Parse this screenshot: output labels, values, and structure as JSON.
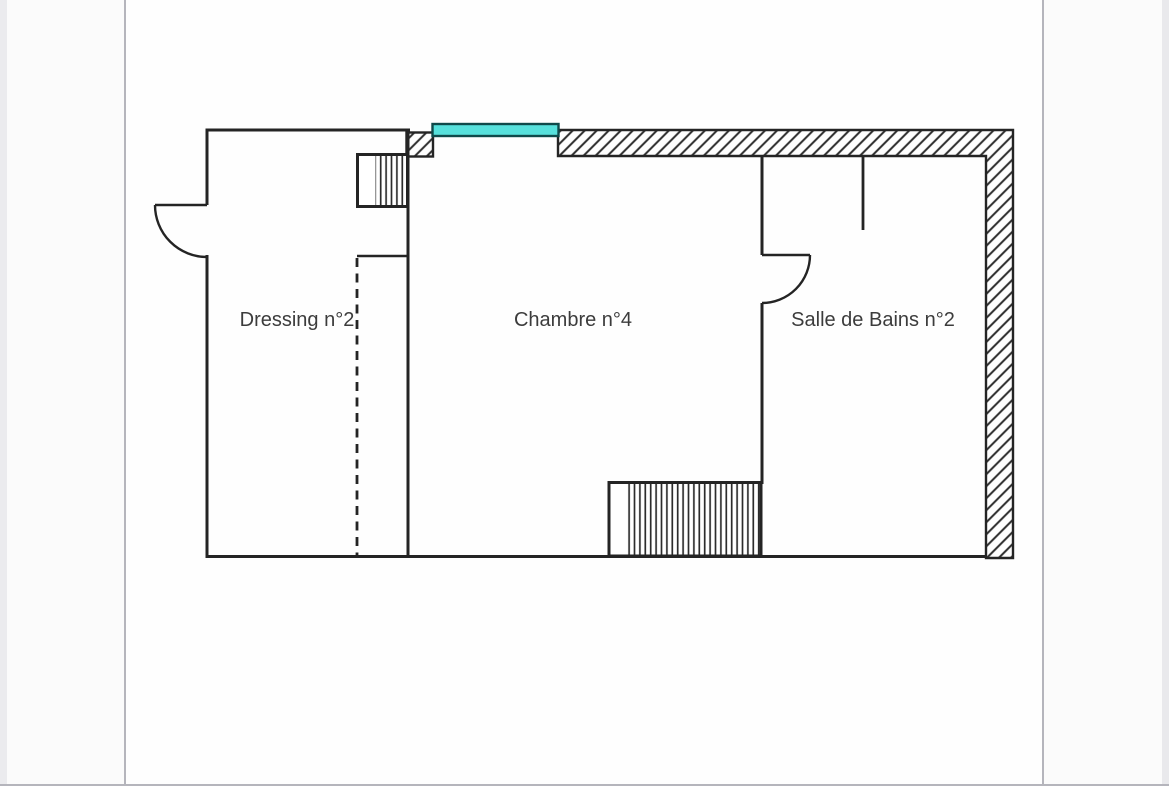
{
  "page": {
    "background_color": "#fbfbfb",
    "sheet_color": "#fefefe",
    "sheet_edge_color": "#b5b5bc"
  },
  "plan": {
    "wall_color": "#242424",
    "text_color": "#3c3c3c",
    "rooms": [
      {
        "label": "Dressing n°2"
      },
      {
        "label": "Chambre n°4"
      },
      {
        "label": "Salle de Bains n°2"
      }
    ],
    "window": {
      "fill_color": "#57e1dc",
      "frame_color": "#0f4a4a"
    }
  }
}
